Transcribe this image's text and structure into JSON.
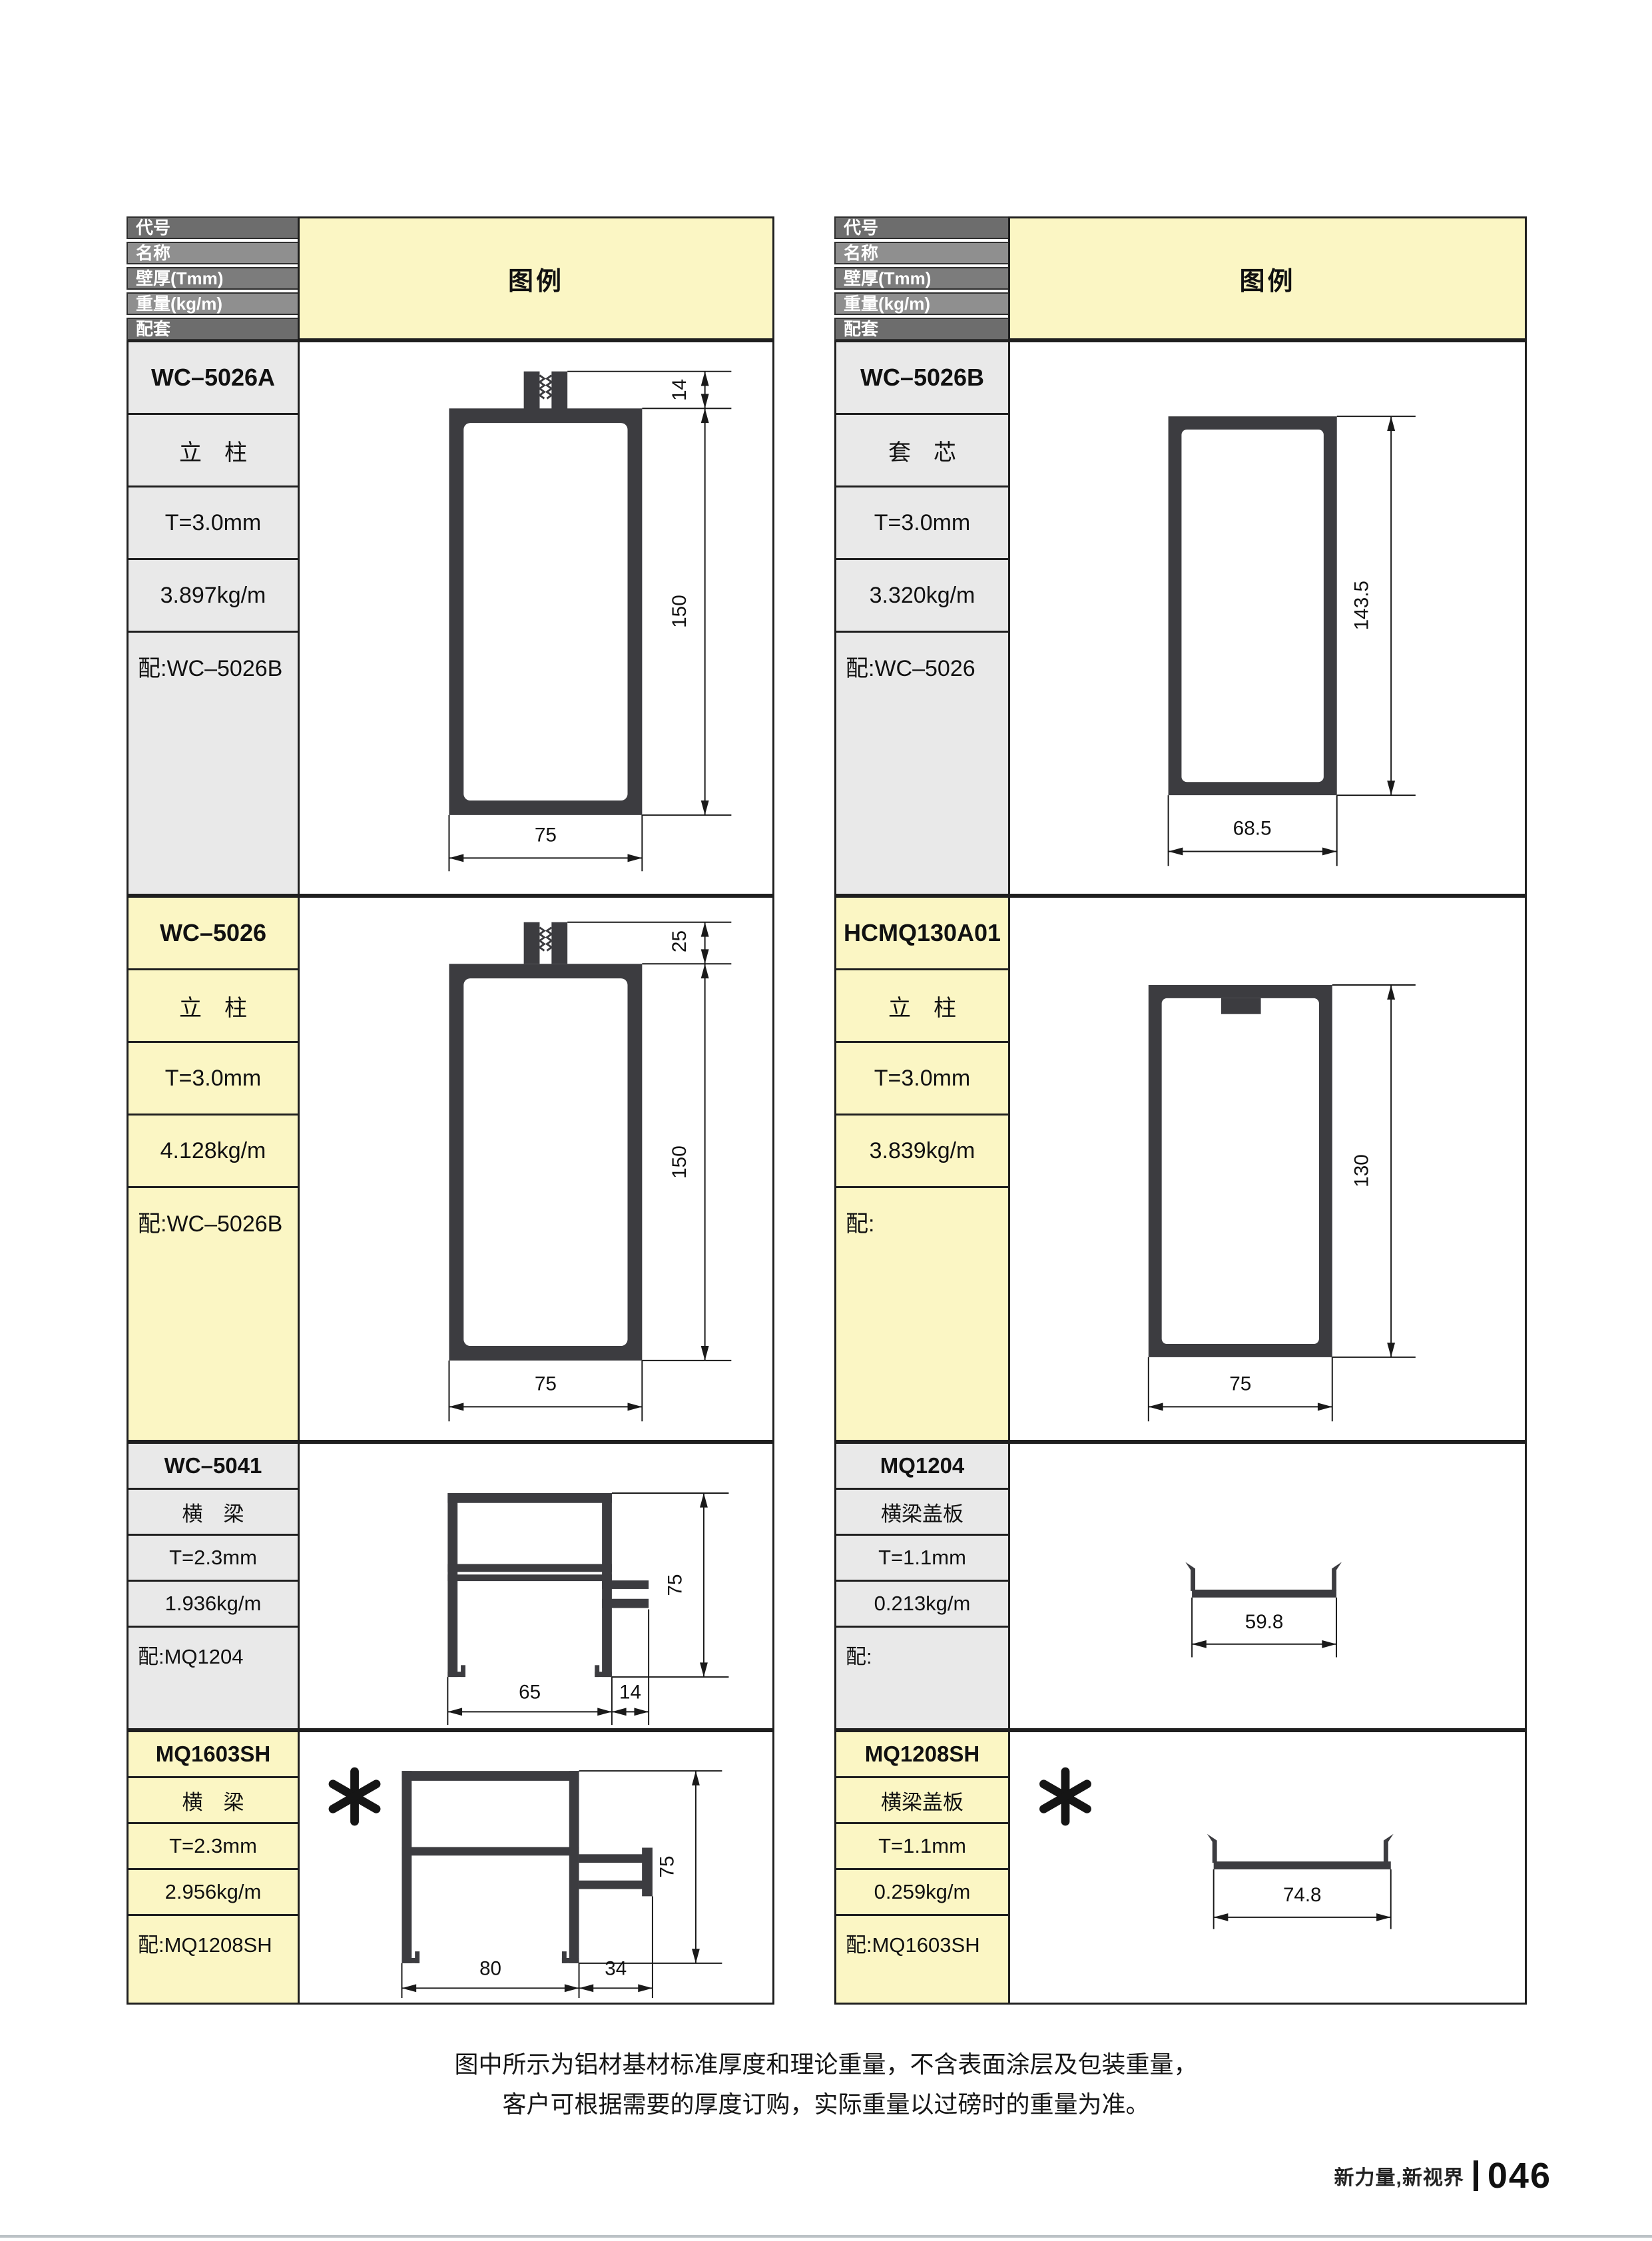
{
  "header": {
    "field_labels": [
      "代号",
      "名称",
      "壁厚(Tmm)",
      "重量(kg/m)",
      "配套"
    ],
    "legend_label": "图例"
  },
  "products": [
    {
      "code": "WC–5026A",
      "name": "立　柱",
      "thickness": "T=3.0mm",
      "weight": "3.897kg/m",
      "match": "配:WC–5026B",
      "dims": {
        "tab_height": "14",
        "height": "150",
        "width": "75"
      }
    },
    {
      "code": "WC–5026B",
      "name": "套　芯",
      "thickness": "T=3.0mm",
      "weight": "3.320kg/m",
      "match": "配:WC–5026",
      "dims": {
        "height": "143.5",
        "width": "68.5"
      }
    },
    {
      "code": "WC–5026",
      "name": "立　柱",
      "thickness": "T=3.0mm",
      "weight": "4.128kg/m",
      "match": "配:WC–5026B",
      "dims": {
        "tab_height": "25",
        "height": "150",
        "width": "75"
      }
    },
    {
      "code": "HCMQ130A01",
      "name": "立　柱",
      "thickness": "T=3.0mm",
      "weight": "3.839kg/m",
      "match": "配:",
      "dims": {
        "height": "130",
        "width": "75"
      }
    },
    {
      "code": "WC–5041",
      "name": "横　梁",
      "thickness": "T=2.3mm",
      "weight": "1.936kg/m",
      "match": "配:MQ1204",
      "dims": {
        "height": "75",
        "width": "65",
        "tab_width": "14"
      }
    },
    {
      "code": "MQ1204",
      "name": "横梁盖板",
      "thickness": "T=1.1mm",
      "weight": "0.213kg/m",
      "match": "配:",
      "dims": {
        "width": "59.8"
      }
    },
    {
      "code": "MQ1603SH",
      "name": "横　梁",
      "thickness": "T=2.3mm",
      "weight": "2.956kg/m",
      "match": "配:MQ1208SH",
      "marked": true,
      "dims": {
        "height": "75",
        "width": "80",
        "arm_width": "34"
      }
    },
    {
      "code": "MQ1208SH",
      "name": "横梁盖板",
      "thickness": "T=1.1mm",
      "weight": "0.259kg/m",
      "match": "配:MQ1603SH",
      "marked": true,
      "dims": {
        "width": "74.8"
      }
    }
  ],
  "footer": {
    "note_line1": "图中所示为铝材基材标准厚度和理论重量，不含表面涂层及包装重量，",
    "note_line2": "客户可根据需要的厚度订购，实际重量以过磅时的重量为准。",
    "brand": "新力量,新视界",
    "page_number": "046"
  },
  "colors": {
    "legend_background": "#FBF6C4",
    "row_gray_background": "#E9E9E9",
    "row_yellow_background": "#FBF6C4",
    "header_bar_dark": "#6D6D6D",
    "header_bar_light": "#8F8F8F",
    "header_bar_mid": "#7C7C7C",
    "profile_fill": "#3C3C40",
    "border": "#1F1F1F"
  }
}
